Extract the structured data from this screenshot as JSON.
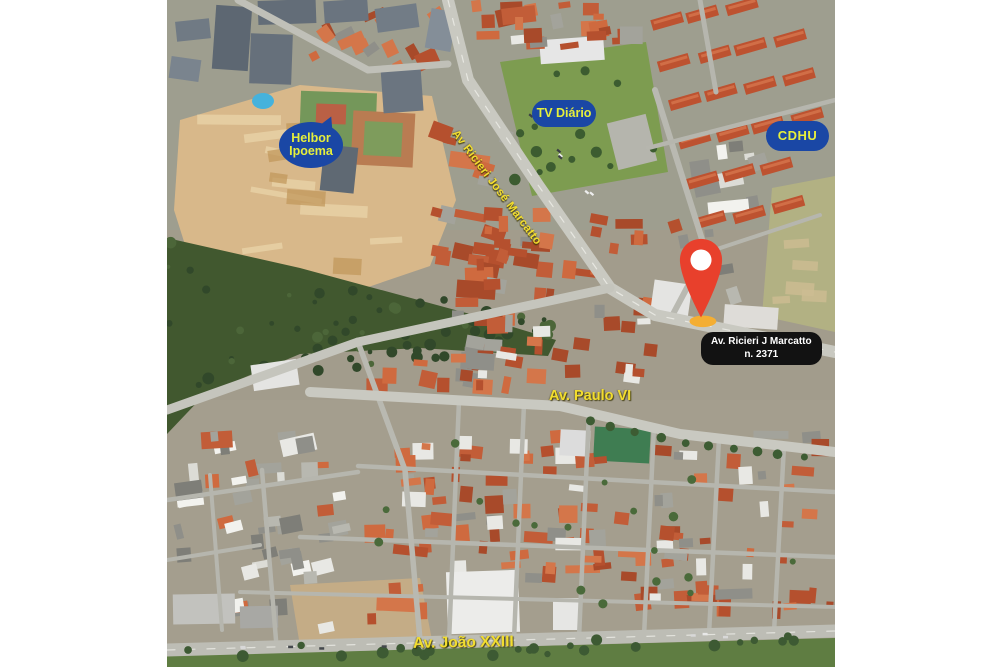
{
  "map": {
    "badges": {
      "helbor": {
        "line1": "Helbor",
        "line2": "Ipoema"
      },
      "tv_diario": {
        "label": "TV Diário"
      },
      "cdhu": {
        "label": "CDHU"
      }
    },
    "road_labels": {
      "ricieri": "Av Ricieri José Marcatto",
      "paulo_vi": "Av. Paulo VI",
      "joao_xxiii": "Av. João XXIII"
    },
    "marker": {
      "icon": "map-pin-icon",
      "address_line1": "Av. Ricieri J Marcatto",
      "address_line2": "n. 2371"
    }
  },
  "colors": {
    "page_bg": "#ffffff",
    "badge_blue": "#1a47a5",
    "badge_yellow": "#e6ef3c",
    "label_yellow": "#f2dd2f",
    "pin_red": "#e8402c",
    "pin_base_yellow": "#f4ae33",
    "address_bg": "#121212",
    "address_text": "#ffffff"
  }
}
